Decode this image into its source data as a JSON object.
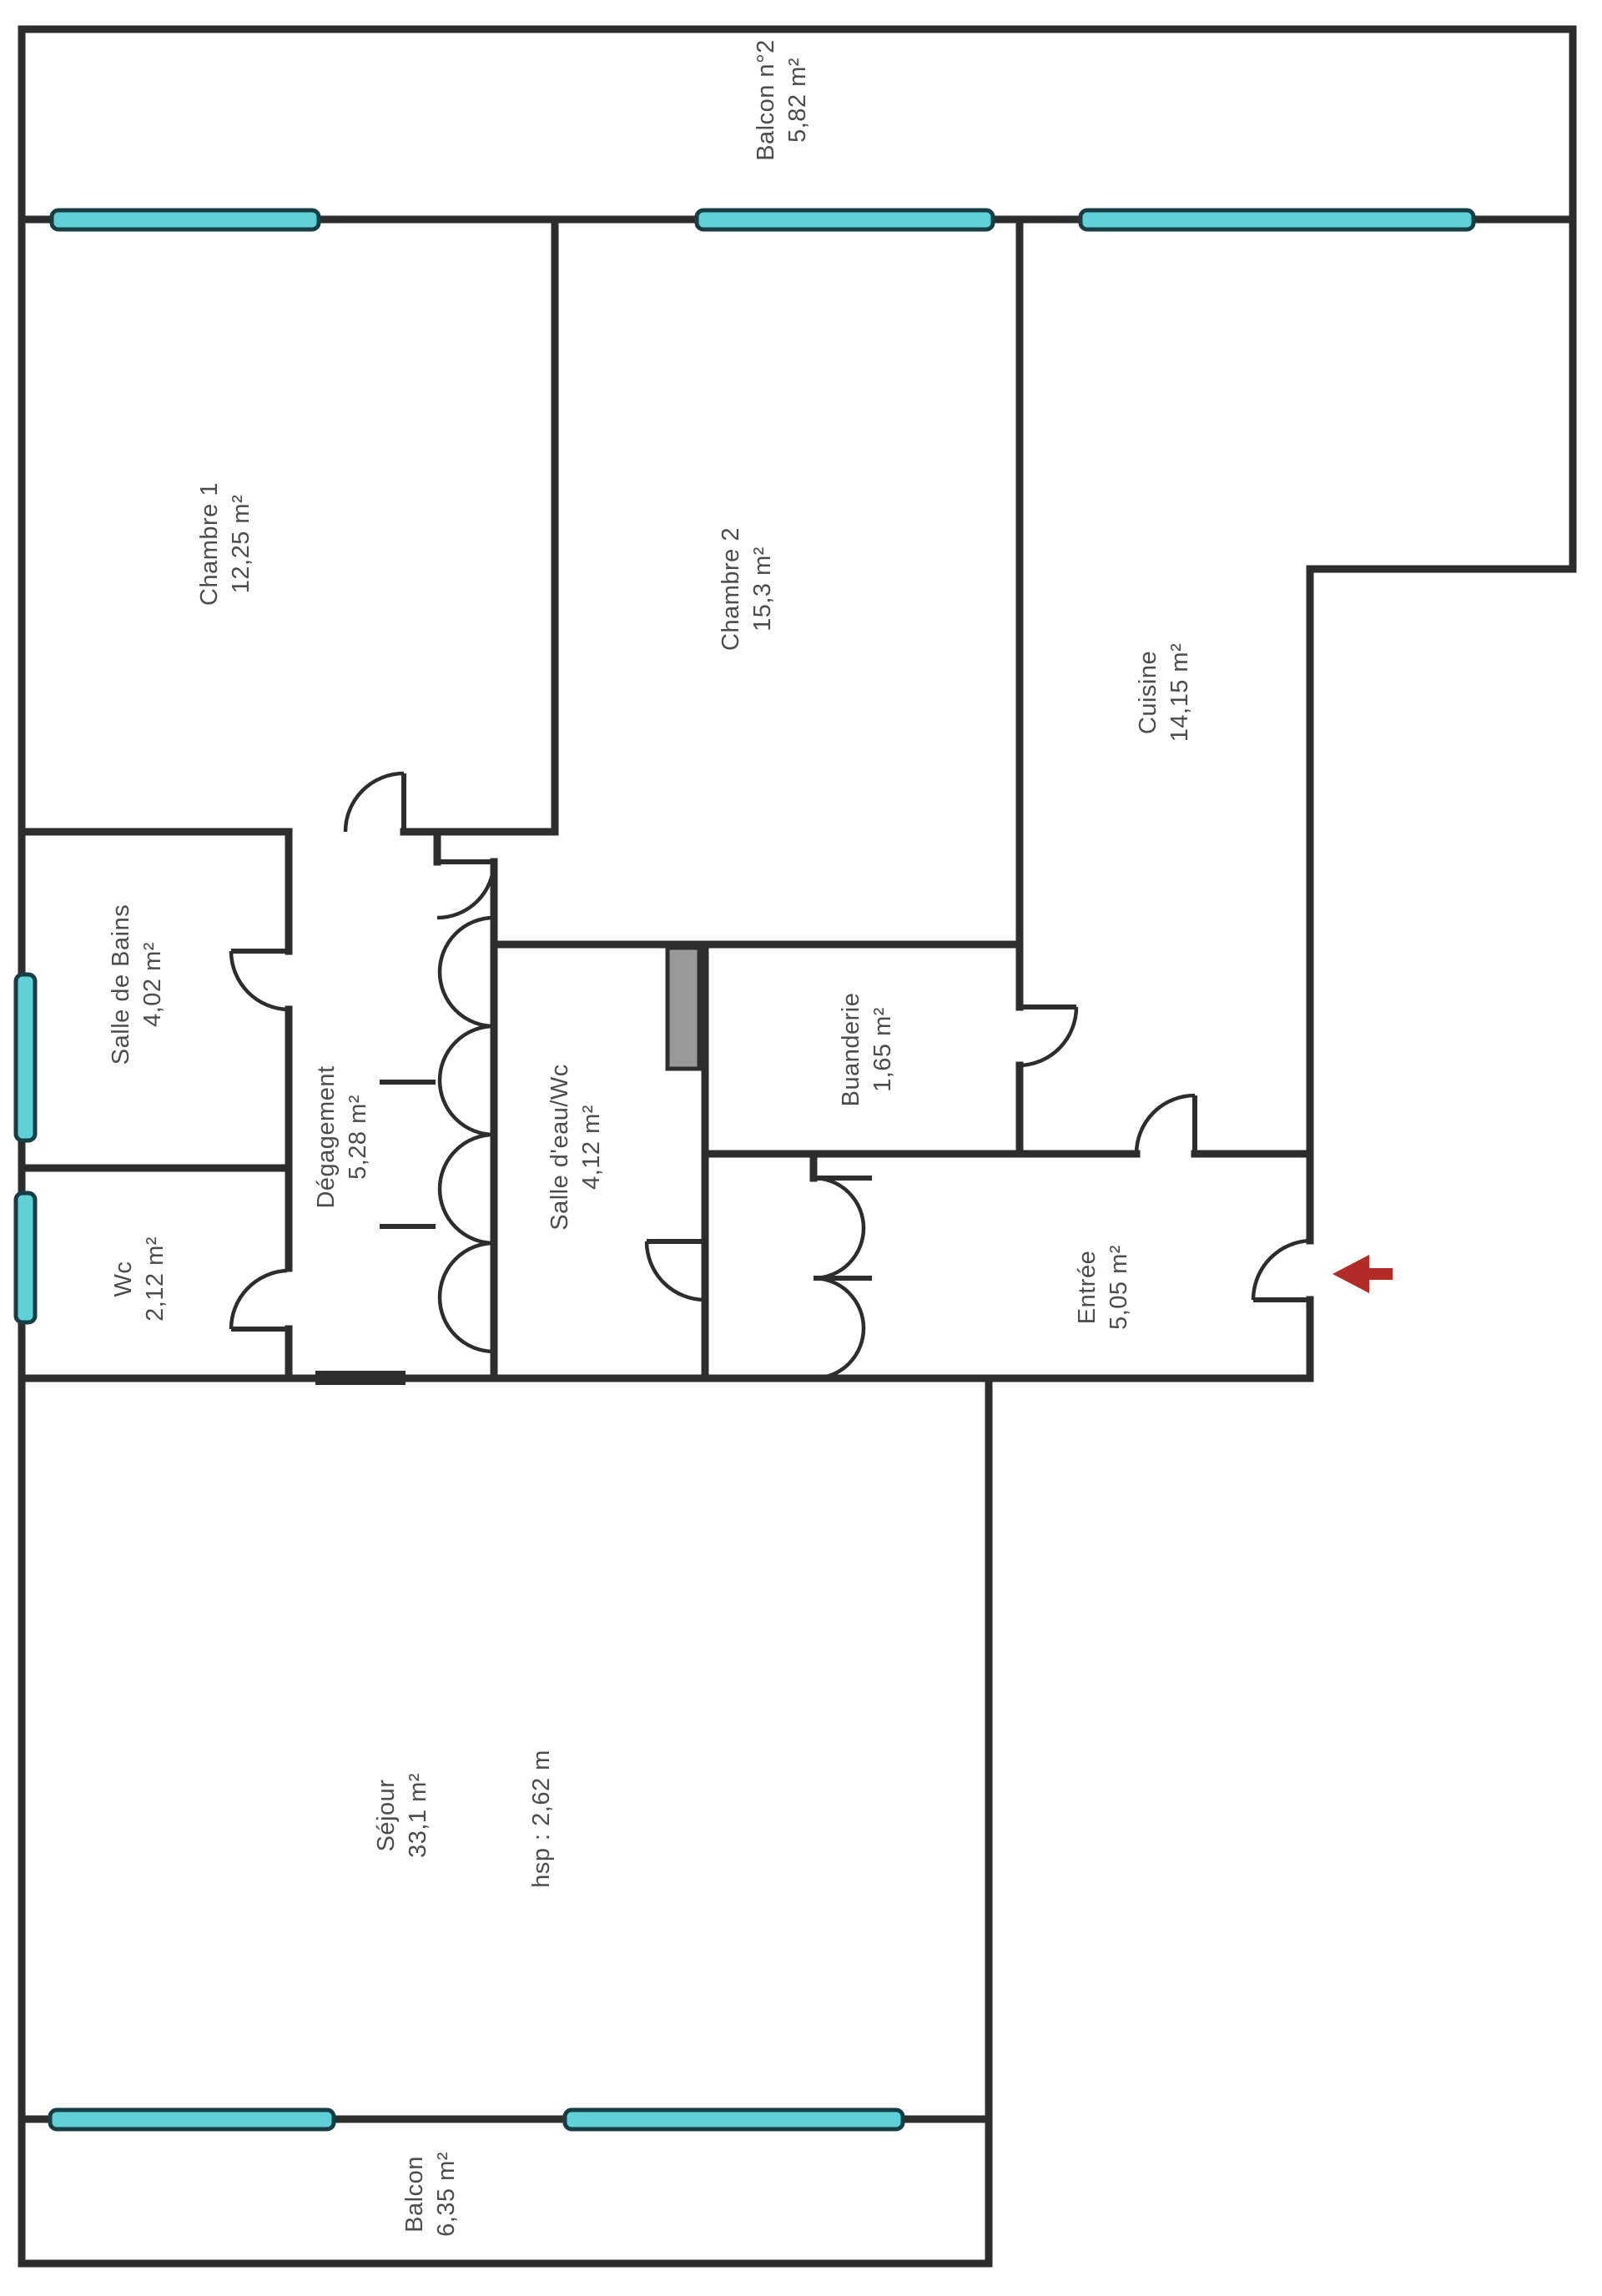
{
  "plan": {
    "rooms": [
      {
        "name": "Balcon n°2",
        "area": "5,82 m²"
      },
      {
        "name": "Chambre 1",
        "area": "12,25 m²"
      },
      {
        "name": "Chambre 2",
        "area": "15,3 m²"
      },
      {
        "name": "Cuisine",
        "area": "14,15 m²"
      },
      {
        "name": "Salle de Bains",
        "area": "4,02 m²"
      },
      {
        "name": "Dégagement",
        "area": "5,28 m²"
      },
      {
        "name": "Salle d'eau/Wc",
        "area": "4,12 m²"
      },
      {
        "name": "Buanderie",
        "area": "1,65 m²"
      },
      {
        "name": "Wc",
        "area": "2,12 m²"
      },
      {
        "name": "Entrée",
        "area": "5,05 m²"
      },
      {
        "name": "Séjour",
        "area": "33,1 m²"
      },
      {
        "name": "Balcon",
        "area": "6,35 m²"
      }
    ],
    "ceiling_note": "hsp : 2,62 m",
    "colors": {
      "wall": "#2d2d2d",
      "window_fill": "#5fd0d8",
      "window_stroke": "#173e44",
      "duct_fill": "#999999",
      "duct_stroke": "#2d2d2d",
      "arrow": "#b32b27"
    }
  }
}
